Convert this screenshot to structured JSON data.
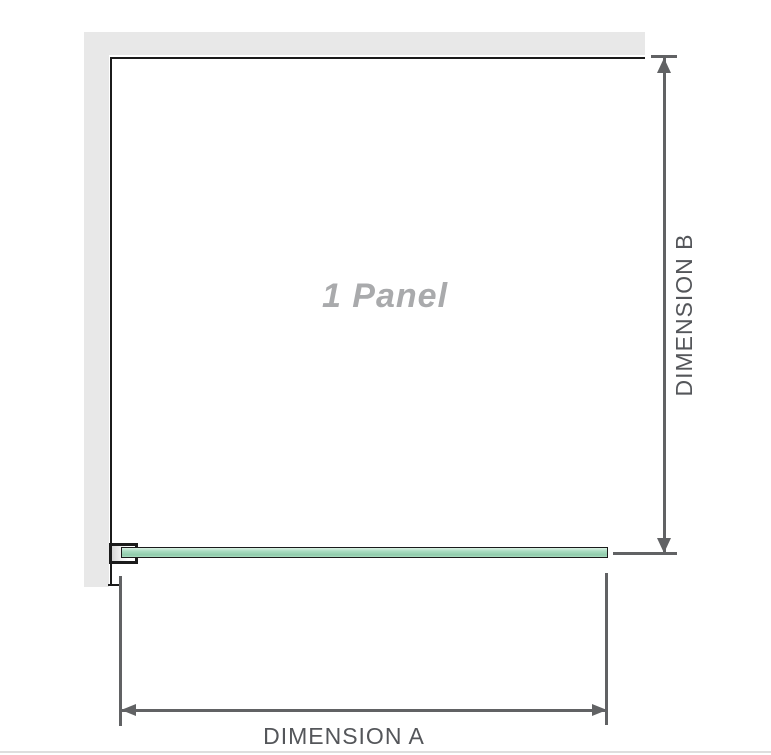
{
  "diagram": {
    "panel_label": "1 Panel",
    "dimension_a_label": "DIMENSION A",
    "dimension_b_label": "DIMENSION B"
  },
  "colors": {
    "wall": "#e8e8e8",
    "panel_edge": "#1b1b1b",
    "glass_light": "#daf1e4",
    "glass_mid": "#a9dcc1",
    "glass_dark": "#8fcbaa",
    "dimension_line": "#616264",
    "label_text": "#54565a",
    "panel_label_text": "#a9aaac",
    "page_border": "#dedede"
  }
}
